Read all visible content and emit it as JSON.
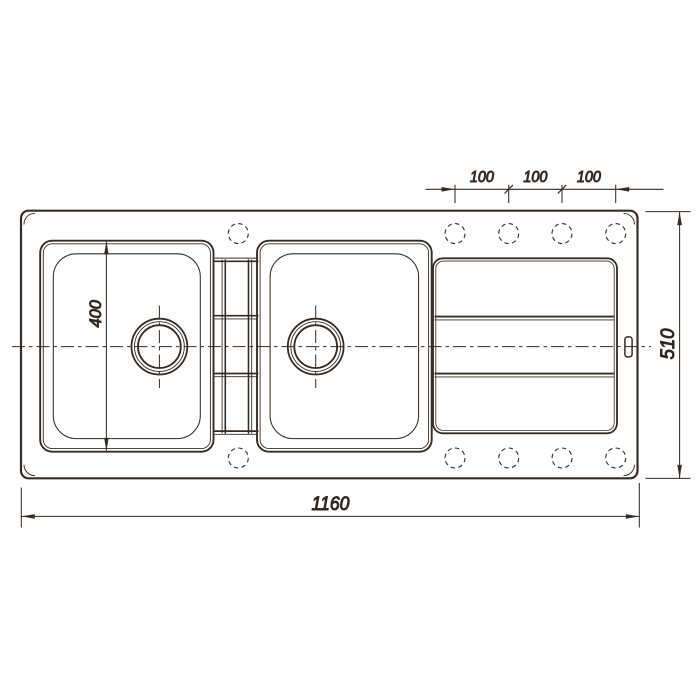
{
  "drawing": {
    "background": "#ffffff",
    "line_color": "#372c22",
    "text_color": "#2c231b",
    "dimensions": {
      "overall_width_mm": "1160",
      "overall_depth_mm": "510",
      "bowl_width_mm": "400",
      "hole_spacings_mm": [
        "100",
        "100",
        "100"
      ]
    }
  }
}
